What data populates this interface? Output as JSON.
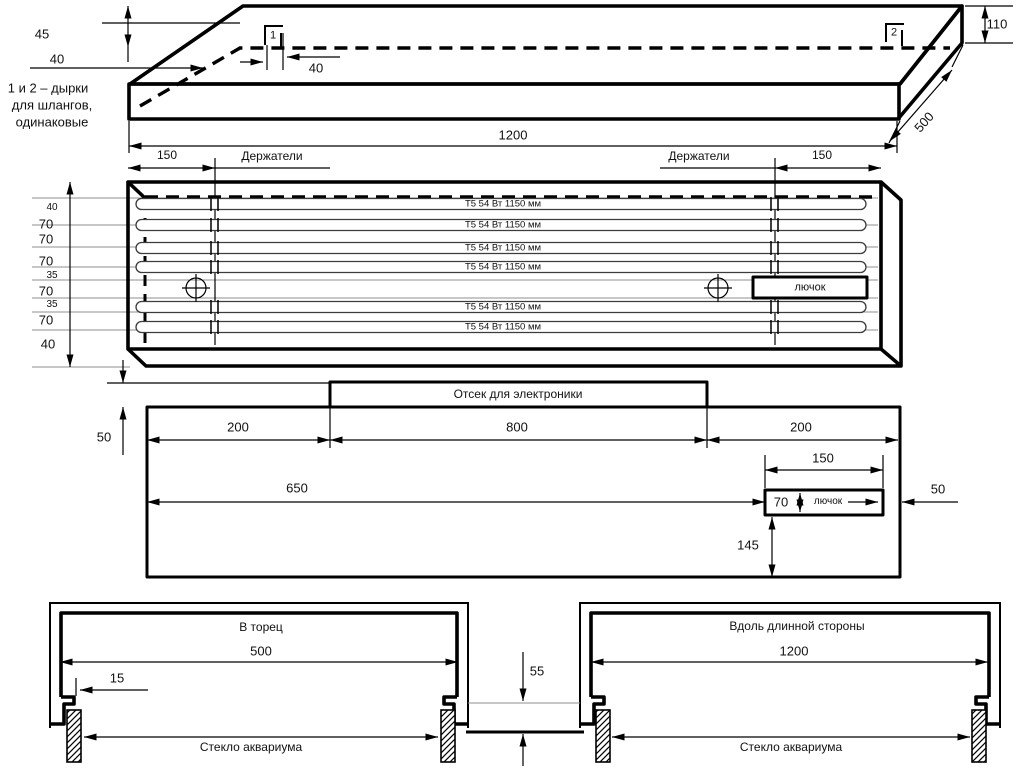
{
  "note": {
    "lines": [
      "1 и 2 – дырки",
      "для шлангов,",
      "одинаковые"
    ]
  },
  "top_view": {
    "height_45": "45",
    "offset_40_left": "40",
    "offset_40_right": "40",
    "hole_1": "1",
    "hole_2": "2",
    "height_110": "110",
    "depth_500": "500",
    "length_1200": "1200"
  },
  "plan_view": {
    "offset_150_left": "150",
    "holders_left": "Держатели",
    "holders_right": "Держатели",
    "offset_150_right": "150",
    "hatch_label": "лючок",
    "lamps": [
      "Т5 54 Вт 1150 мм",
      "Т5 54 Вт 1150 мм",
      "Т5 54 Вт 1150 мм",
      "Т5 54 Вт 1150 мм",
      "Т5 54 Вт 1150 мм",
      "Т5 54 Вт 1150 мм"
    ],
    "left_dims": [
      "40",
      "70",
      "70",
      "70",
      "35",
      "70",
      "35",
      "70",
      "40"
    ]
  },
  "bottom_view": {
    "compartment": "Отсек для электроники",
    "height_50": "50",
    "seg_200_left": "200",
    "seg_800": "800",
    "seg_200_right": "200",
    "len_650": "650",
    "hatch_150": "150",
    "hatch_70": "70",
    "hatch_label": "лючок",
    "right_50": "50",
    "down_145": "145"
  },
  "sections": {
    "end": {
      "title": "В торец",
      "width": "500",
      "lip_15": "15",
      "glass": "Стекло аквариума"
    },
    "side": {
      "title": "Вдоль длинной стороны",
      "width": "1200",
      "glass": "Стекло аквариума"
    },
    "gap_55": "55"
  }
}
